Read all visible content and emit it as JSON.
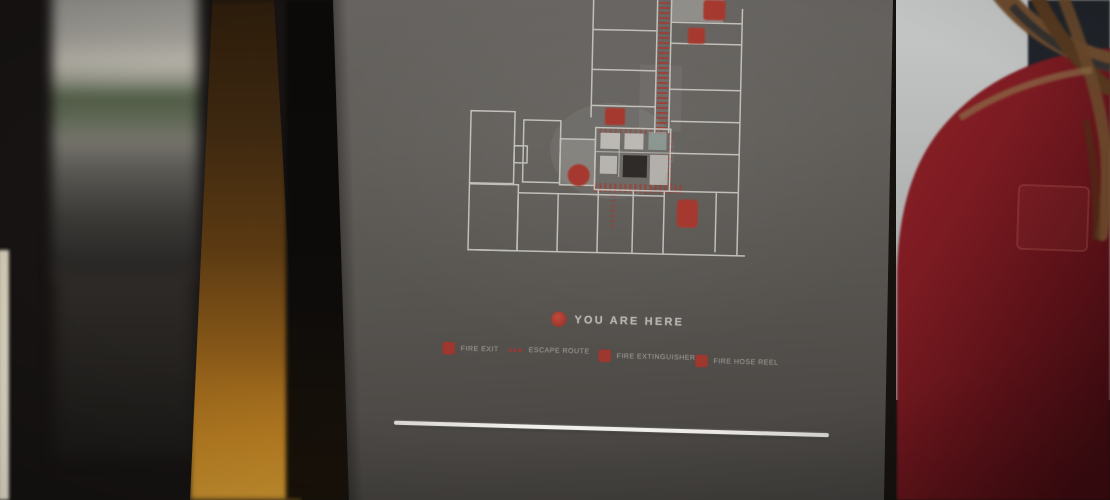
{
  "sign": {
    "you_are_here_label": "YOU ARE HERE",
    "legend": {
      "items": [
        {
          "label": "FIRE EXIT",
          "icon": "fire-exit-marker-icon"
        },
        {
          "label": "ESCAPE ROUTE",
          "icon": "escape-route-line-icon"
        },
        {
          "label": "FIRE EXTINGUISHER",
          "icon": "fire-extinguisher-marker-icon"
        },
        {
          "label": "FIRE HOSE REEL",
          "icon": "fire-hose-reel-marker-icon"
        }
      ]
    },
    "map": {
      "type": "evacuation-floor-plan",
      "marker_icons": [
        "you-are-here-map-marker",
        "fire-exit-map-marker",
        "fire-extinguisher-map-marker",
        "fire-hose-reel-map-marker"
      ],
      "route_style": "red-dotted"
    },
    "colors": {
      "accent_red": "#9e372d",
      "board_gray": "#56534f",
      "plan_lines": "#c9c7c2",
      "text_primary": "#b6b3ae",
      "text_secondary": "#8f8c87",
      "divider_line": "#efede9",
      "clothing_red": "#7c1b22",
      "wood_amber": "#b77d22",
      "wall_gray": "#c3c5c3"
    }
  }
}
